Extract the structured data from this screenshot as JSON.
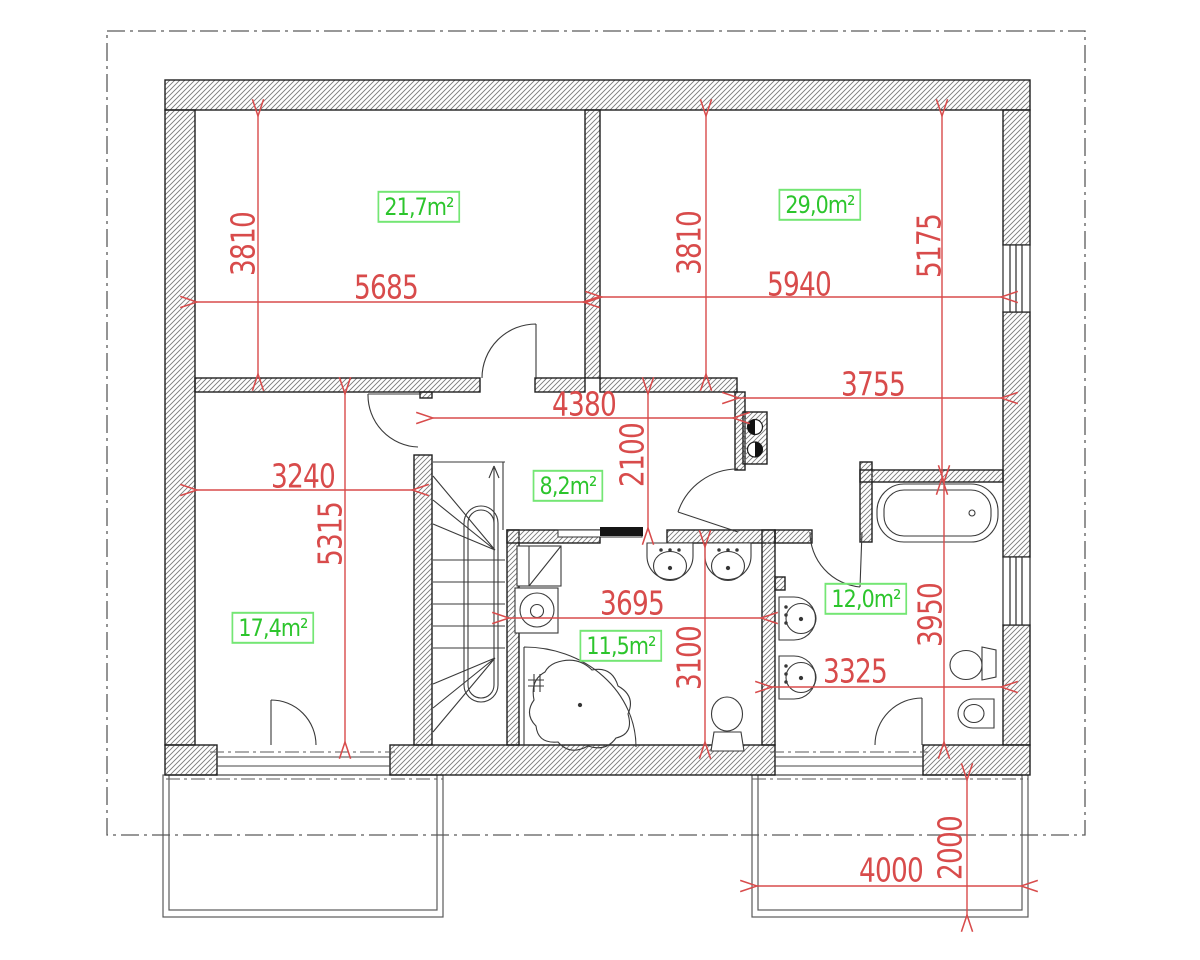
{
  "drawing": {
    "type": "architectural floor plan",
    "units": "mm",
    "room_areas": {
      "bedroom_top_left": "21,7m²",
      "room_top_right": "29,0m²",
      "hall": "8,2m²",
      "bedroom_bottom_left": "17,4m²",
      "bathroom": "11,5m²",
      "bathroom_right": "12,0m²"
    },
    "dimensions": {
      "d3810_left": "3810",
      "d5685": "5685",
      "d3810_right": "3810",
      "d5940": "5940",
      "d5175": "5175",
      "d3755": "3755",
      "d4380": "4380",
      "d2100": "2100",
      "d3240": "3240",
      "d5315": "5315",
      "d3695": "3695",
      "d3100": "3100",
      "d3950": "3950",
      "d3325": "3325",
      "d4000": "4000",
      "d2000": "2000"
    },
    "colors": {
      "dimension_red": "#d84b4b",
      "area_green": "#2cc52c",
      "area_box_green": "#74e674",
      "wall_line": "#1f1f1f",
      "hatch": "#7a7a7a"
    }
  }
}
